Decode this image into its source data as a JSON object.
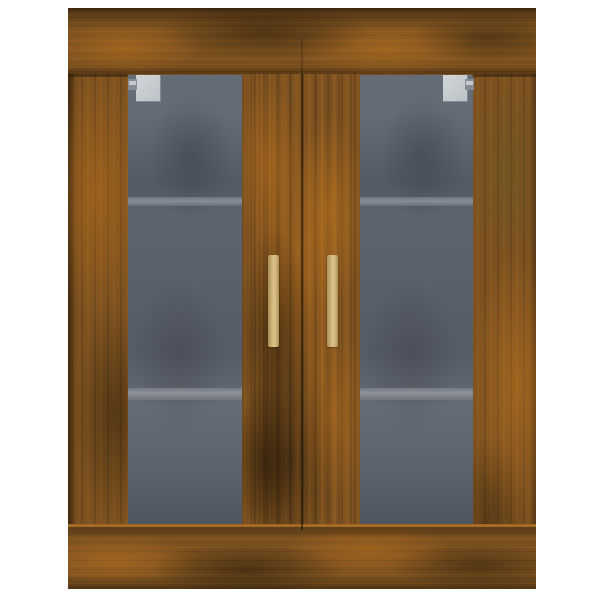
{
  "image": {
    "kind": "product-photo",
    "subject": "wall cabinet with two glass doors",
    "finish": "smoked oak wood",
    "visible_text": "",
    "background": "white seamless backdrop"
  },
  "structure": {
    "frame": [
      "top-rail",
      "bottom-rail",
      "left-stile",
      "right-stile",
      "center-mullion"
    ],
    "doors": [
      {
        "side": "left",
        "glazing": "tinted glass pane",
        "hinge": "top-left silver hinge",
        "handle": "vertical brass bar"
      },
      {
        "side": "right",
        "glazing": "tinted glass pane",
        "hinge": "top-right silver hinge",
        "handle": "vertical brass bar"
      }
    ],
    "interior": {
      "shelves_visible": 2,
      "shelf_positions": [
        "upper third",
        "lower third"
      ]
    }
  },
  "colors": {
    "background": "#ffffff",
    "wood_base": "#7d5220",
    "wood_highlight": "#b4731f",
    "wood_dark": "#3b2a0e",
    "wood_edge_dark": "#2c1f08",
    "wood_olive": "#5f5526",
    "glass": "#5c6470",
    "glass_dark": "#4d5663",
    "shelf_line": "#878c95",
    "handle_gold": "#cdb37a",
    "handle_gold_dark": "#a98f55",
    "hinge_light": "#c8ccd1",
    "hinge_gray": "#868c92"
  }
}
